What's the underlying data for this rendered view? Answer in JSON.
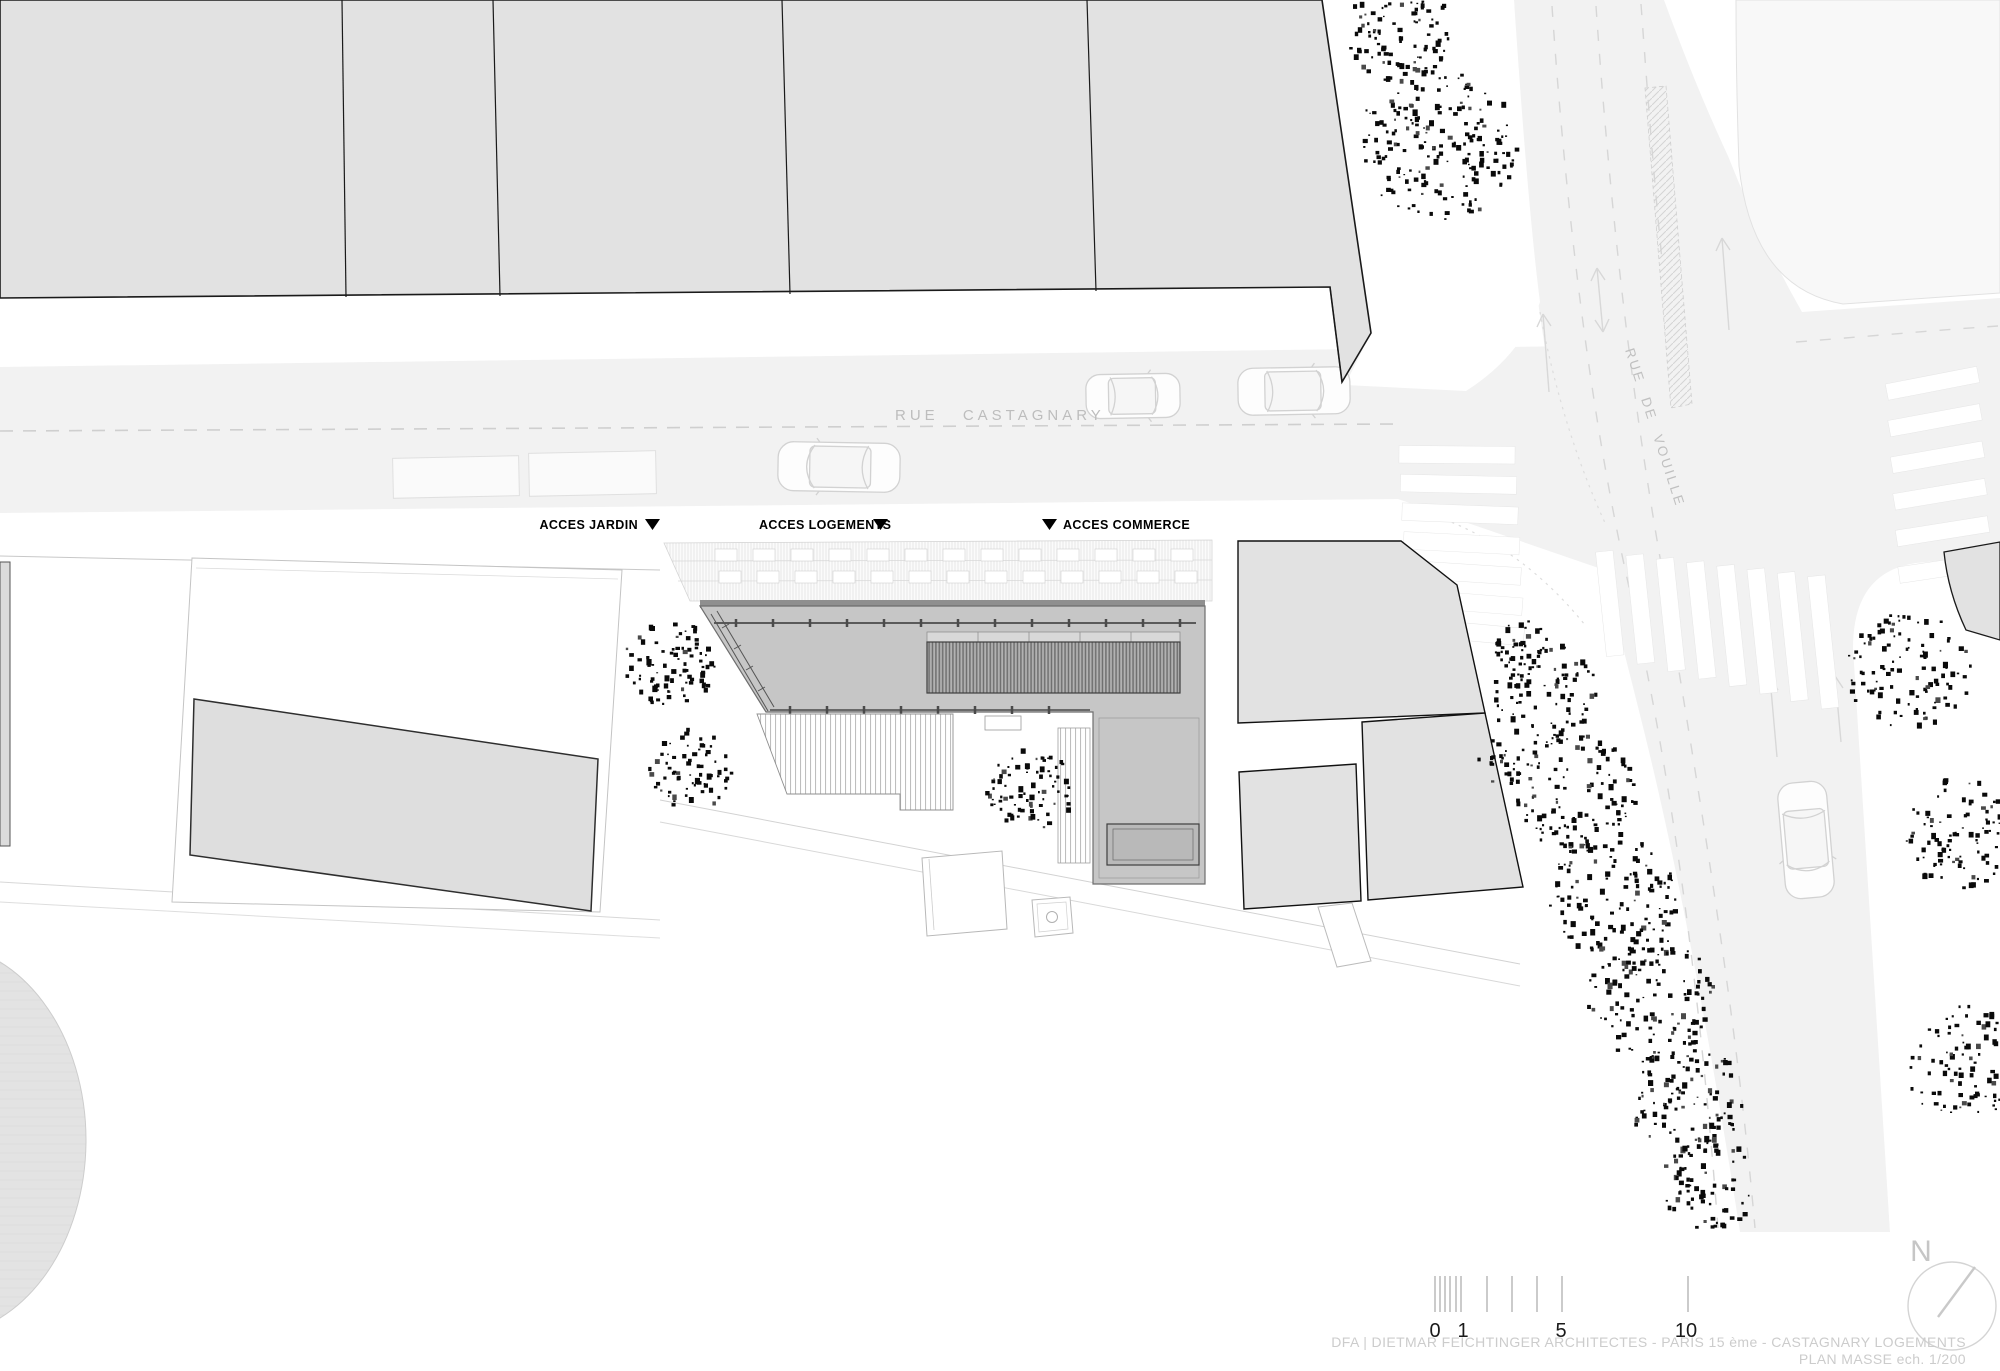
{
  "drawing": {
    "discipline": "architecture site plan",
    "title_block": {
      "line1": "DFA | DIETMAR FEICHTINGER ARCHITECTES - PARIS 15 ème - CASTAGNARY LOGEMENTS",
      "line2": "PLAN MASSE ech. 1/200"
    },
    "scale": "1/200",
    "north_letter": "N"
  },
  "streets": {
    "castagnary": "RUE CASTAGNARY",
    "vouille": "RUE DE VOUILLE"
  },
  "access_labels": {
    "jardin": "ACCES JARDIN",
    "logements": "ACCES LOGEMENTS",
    "commerce": "ACCES COMMERCE"
  },
  "scale_bar": {
    "labels": [
      "0",
      "1",
      "5",
      "10"
    ],
    "units_meters": [
      0,
      1,
      5,
      10
    ]
  },
  "colors": {
    "street_fill": "#f2f2f2",
    "parcel_fill": "#e2e2e2",
    "building_roof": "#c6c6c6",
    "dark_roof_band": "#b2b2b2",
    "garden_slab": "#dedede",
    "tree_dots": "#0a0a0a",
    "street_label_gray": "#bdbdbd",
    "title_gray": "#cccccc"
  }
}
